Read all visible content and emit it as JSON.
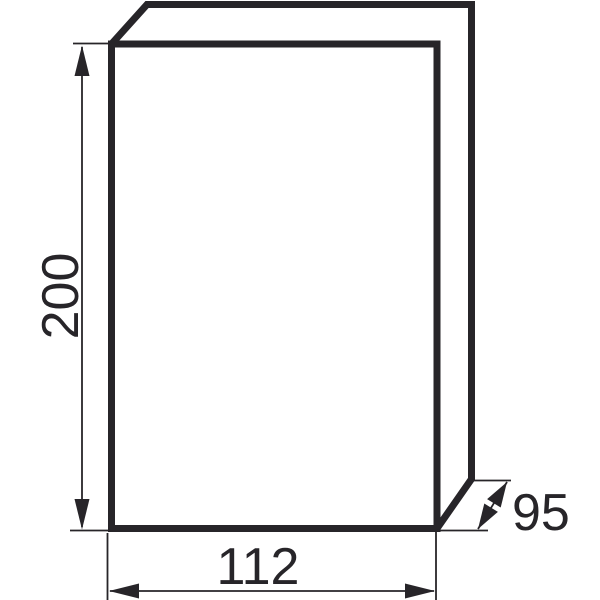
{
  "colors": {
    "ink": "#272529",
    "background": "#ffffff"
  },
  "drawing": {
    "object": "enclosure-box-3d-outline",
    "dimension_labels": {
      "height": "200",
      "width": "112",
      "depth": "95"
    }
  }
}
